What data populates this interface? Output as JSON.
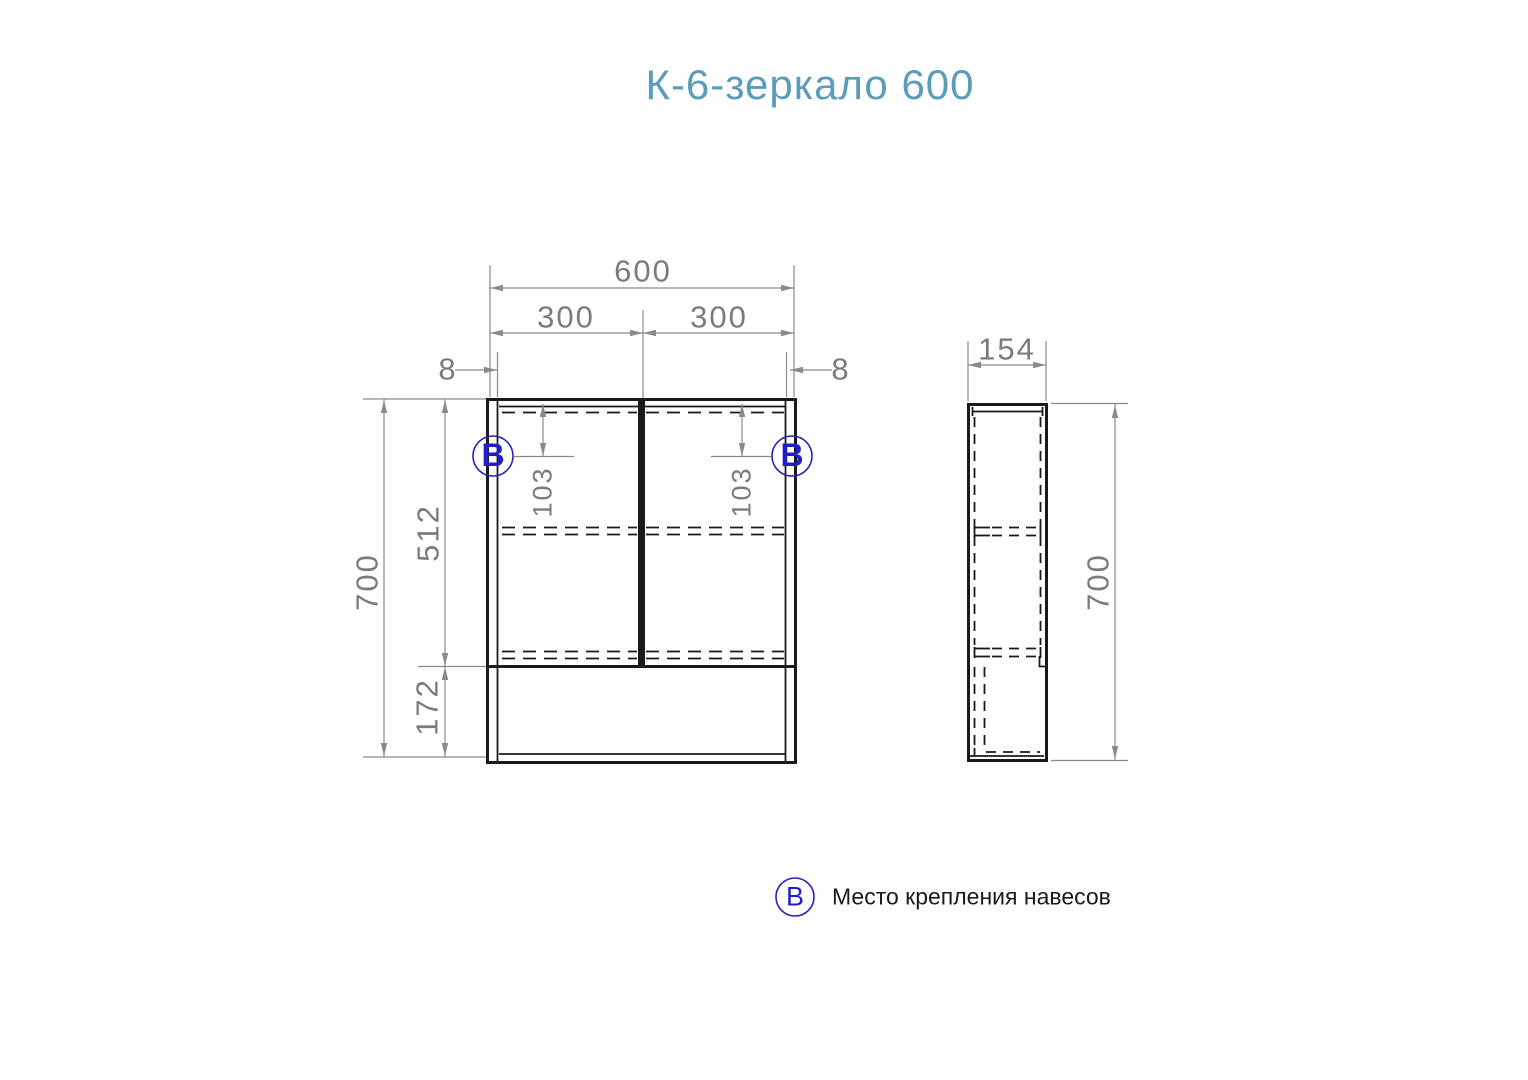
{
  "title": "К-6-зеркало 600",
  "front_view": {
    "dims": {
      "total_width": "600",
      "door_width_left": "300",
      "door_width_right": "300",
      "side_panel_left": "8",
      "side_panel_right": "8",
      "total_height": "700",
      "upper_section_height": "512",
      "lower_section_height": "172",
      "mount_offset_left": "103",
      "mount_offset_right": "103"
    }
  },
  "side_view": {
    "dims": {
      "depth": "154",
      "total_height": "700"
    }
  },
  "marker": {
    "symbol": "В"
  },
  "legend": {
    "symbol": "В",
    "label": "Место крепления навесов"
  },
  "colors": {
    "title": "#5b9cba",
    "dimension": "#7b7b7b",
    "drawing_line": "#1a1a1a",
    "marker_accent": "#1f1fc8",
    "background": "#ffffff"
  }
}
